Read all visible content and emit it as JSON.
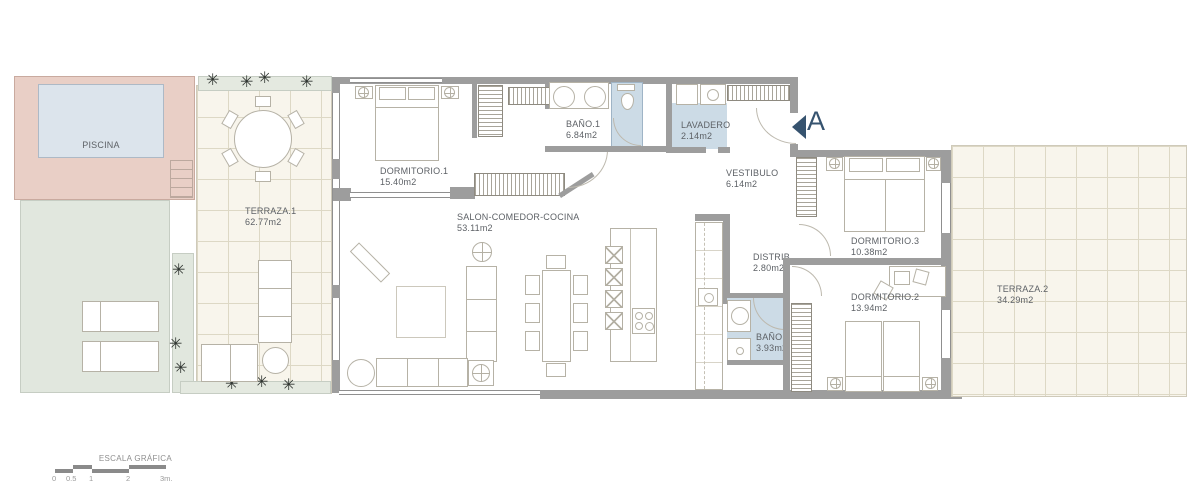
{
  "plan": {
    "rooms": {
      "piscina": {
        "name": "PISCINA"
      },
      "terraza1": {
        "name": "TERRAZA.1",
        "area": "62.77m2"
      },
      "dormitorio1": {
        "name": "DORMITORIO.1",
        "area": "15.40m2"
      },
      "salon": {
        "name": "SALON-COMEDOR-COCINA",
        "area": "53.11m2"
      },
      "bano1": {
        "name": "BAÑO.1",
        "area": "6.84m2"
      },
      "lavadero": {
        "name": "LAVADERO",
        "area": "2.14m2"
      },
      "vestibulo": {
        "name": "VESTIBULO",
        "area": "6.14m2"
      },
      "distrib": {
        "name": "DISTRIB.",
        "area": "2.80m2"
      },
      "dormitorio3": {
        "name": "DORMITORIO.3",
        "area": "10.38m2"
      },
      "dormitorio2": {
        "name": "DORMITORIO.2",
        "area": "13.94m2"
      },
      "bano2": {
        "name": "BAÑO",
        "area": "3.93m2"
      },
      "terraza2": {
        "name": "TERRAZA.2",
        "area": "34.29m2"
      }
    },
    "entrance": {
      "label": "A"
    },
    "scale": {
      "title": "ESCALA GRÁFICA",
      "ticks": [
        "0",
        "0.5",
        "1",
        "2",
        "3m."
      ]
    },
    "icons": {
      "plant": "✳"
    },
    "colors": {
      "wall": "#9d9d9d",
      "pool_water": "#dce4ec",
      "pool_deck": "#e9cfc6",
      "lawn": "#e1e7de",
      "terrace_tile": "#f8f5ec",
      "wet_room": "#ccdbe6",
      "marker_blue": "#36536f"
    }
  }
}
